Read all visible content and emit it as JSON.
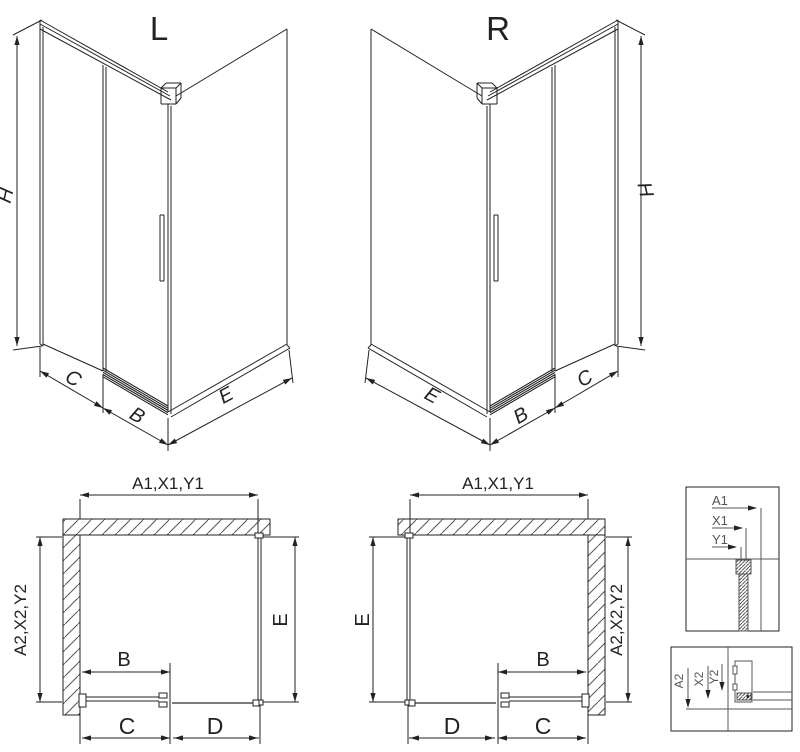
{
  "drawing": {
    "iso_left": {
      "title": "L",
      "dim_h": "H",
      "dim_c": "C",
      "dim_b": "B",
      "dim_e": "E"
    },
    "iso_right": {
      "title": "R",
      "dim_h": "H",
      "dim_c": "C",
      "dim_b": "B",
      "dim_e": "E"
    },
    "plan_left": {
      "dim_top": "A1,X1,Y1",
      "dim_left": "A2,X2,Y2",
      "dim_right": "E",
      "dim_b": "B",
      "dim_c": "C",
      "dim_d": "D"
    },
    "plan_right": {
      "dim_top": "A1,X1,Y1",
      "dim_left": "E",
      "dim_right": "A2,X2,Y2",
      "dim_b": "B",
      "dim_c": "C",
      "dim_d": "D"
    },
    "detail_top": {
      "dim_a1": "A1",
      "dim_x1": "X1",
      "dim_y1": "Y1"
    },
    "detail_bottom": {
      "dim_a2": "A2",
      "dim_x2": "X2",
      "dim_y2": "Y2"
    }
  },
  "colors": {
    "line": "#222222",
    "hatch": "#555555",
    "text": "#222222",
    "detail_text": "#555555",
    "rail_gray": "#7a7a7a",
    "background": "#ffffff"
  }
}
